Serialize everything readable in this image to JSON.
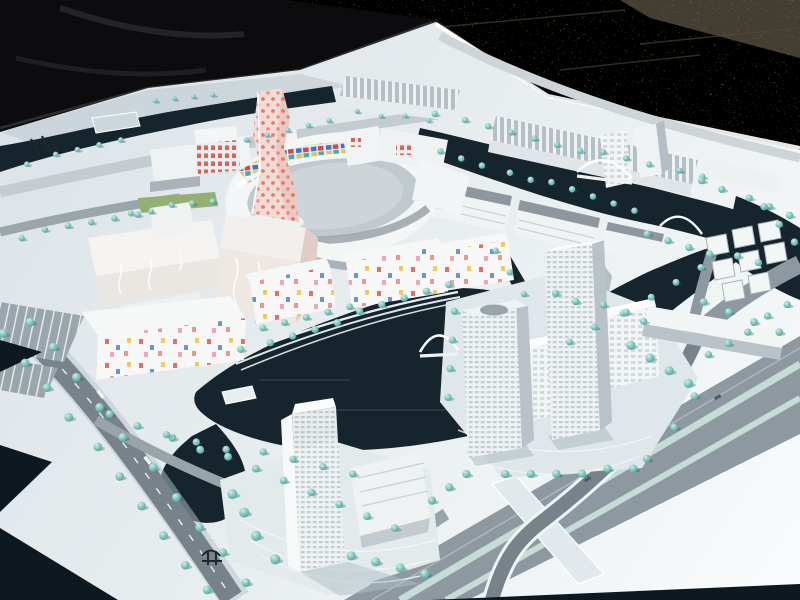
{
  "image": {
    "type": "outdoor photograph",
    "subject": "architectural scale model of a waterfront urban district",
    "alt": "Tilted aerial photo of a white architectural scale model: canals of dark water, teal model trees, white acrylic buildings, an oval courtyard block with colored mosaic panels, a twisted pink tower with red dots, high-rise towers on an island, a highway interchange with a curved flyover, set on a white baseboard lying on brown gravel with a black tarp behind."
  },
  "palette": {
    "tarp": "#0c0c0e",
    "tarp_fold": "#26262b",
    "gravel": "#7d6e59",
    "gravel_light": "#97876f",
    "crack": "#55493a",
    "board_edge": "#ffffff",
    "water": "#16242e",
    "water_deep": "#0e1820",
    "road": "#8d98a0",
    "road_dark": "#77828a",
    "median": "#c7dcd7",
    "tree_mid": "#7cc4bb",
    "building_top": "#f3f5f6",
    "building_side": "#aeb6bc",
    "building_roof": "#8e979d",
    "tower_pink": "#f3dbd5",
    "dot_red": "#e4624e",
    "mosaic_blue": "#3f74c9",
    "mosaic_red": "#d34848",
    "mosaic_teal": "#3fb0a6",
    "mosaic_yellow": "#e5c44e",
    "confetti_pink": "#e8a0b4",
    "lawn": "#93b072",
    "mark": "#20262b",
    "plaza": "#dfe7ea",
    "shadow": "#9fb0ba"
  },
  "scene": {
    "background": [
      {
        "name": "tarp-cover",
        "label": "black tarp folded on ground"
      },
      {
        "name": "gravel-ground",
        "label": "brown gravel / cracked asphalt"
      }
    ],
    "model": [
      {
        "name": "model-baseboard",
        "label": "white model baseboard"
      },
      {
        "name": "canal-network",
        "label": "dark navy canals and basins"
      },
      {
        "name": "oval-courtyard-building",
        "label": "oval ring building with colored mosaic inner facade"
      },
      {
        "name": "pink-dotted-tower",
        "label": "twisted pink tower with red dot pattern"
      },
      {
        "name": "warehouse-row",
        "label": "long ribbed-roof halls along north canal"
      },
      {
        "name": "left-office-complex",
        "label": "cream wavy-facade office blocks"
      },
      {
        "name": "confetti-housing",
        "label": "white housing with scattered colored window squares"
      },
      {
        "name": "island-towers",
        "label": "two gridded high-rise towers on island"
      },
      {
        "name": "bottom-tower",
        "label": "translucent high-rise with podium and plaza"
      },
      {
        "name": "highway-interchange",
        "label": "wide boulevard with medians and curved flyover ramp"
      },
      {
        "name": "arch-bridges",
        "label": "white arched canal bridges"
      },
      {
        "name": "street-trees",
        "label": "rows of teal model trees"
      },
      {
        "name": "parking-lots",
        "label": "striped parking areas"
      },
      {
        "name": "logo-marks",
        "label": "small dark printed marks on baseboard (illegible)"
      }
    ]
  }
}
